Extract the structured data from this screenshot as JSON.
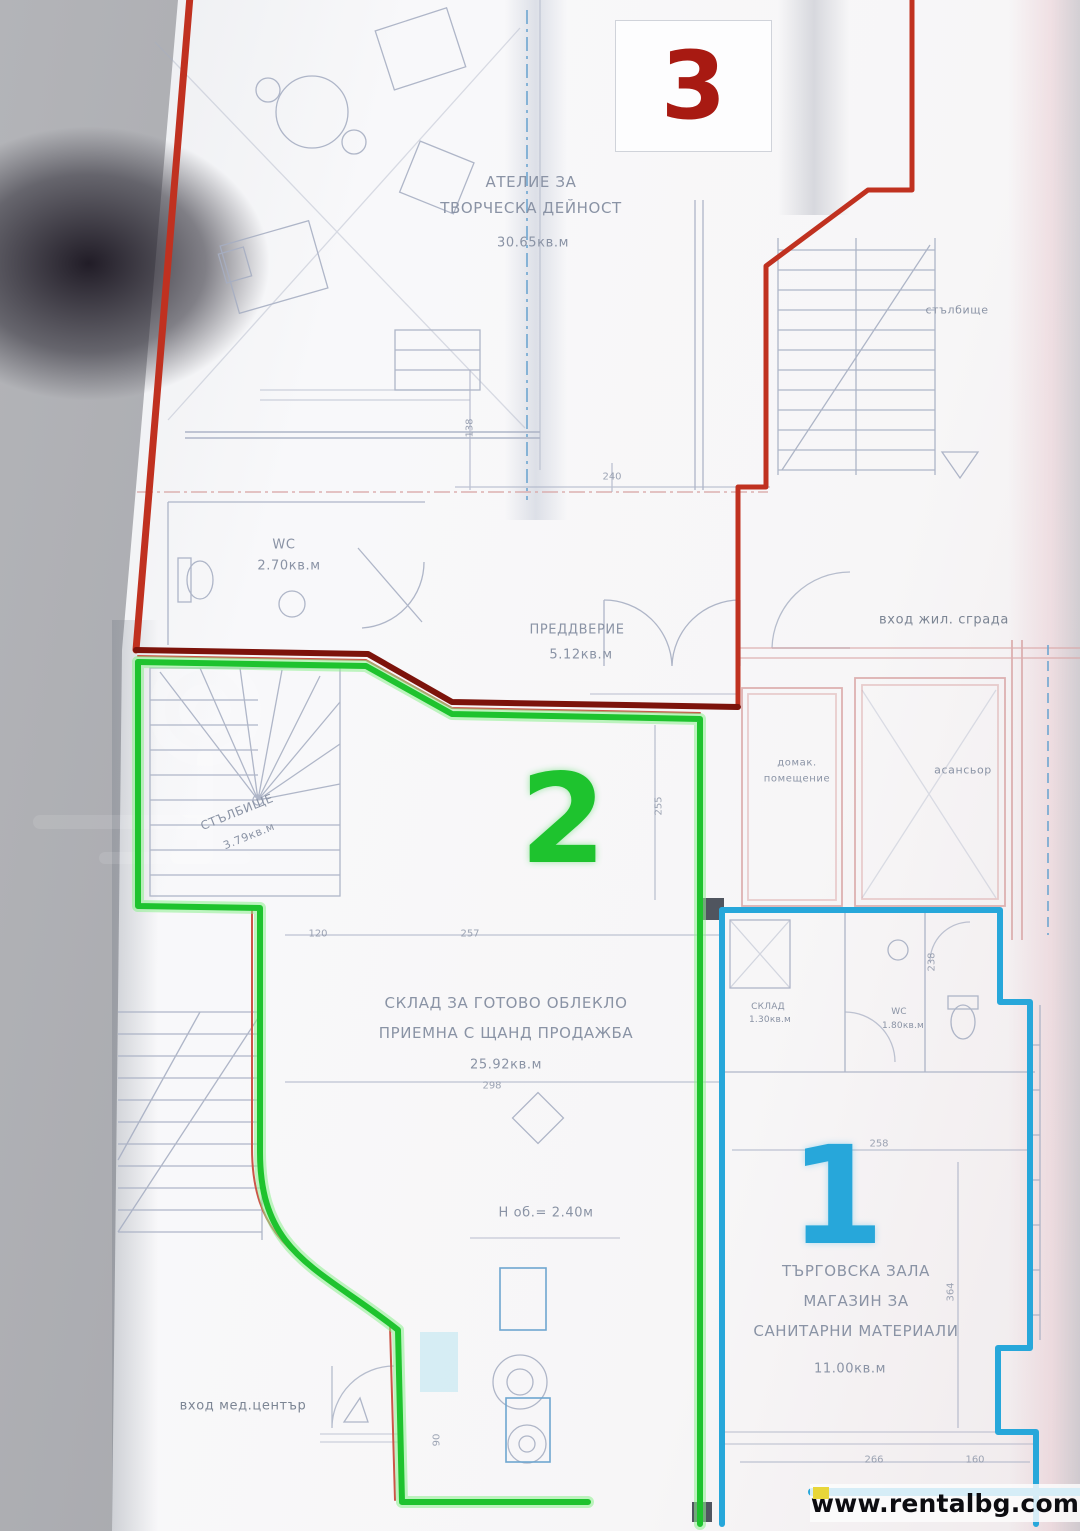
{
  "colors": {
    "unit1": "#27a7da",
    "unit2": "#1ec32e",
    "unit2_glow": "#8df08e",
    "unit3": "#c03120",
    "unit3_dark": "#7c130b",
    "thin_red": "#cc5548",
    "plan_line": "#a6aec2",
    "wall_pink": "#d8a4a4",
    "dash_blue": "#6ea6d0"
  },
  "units": {
    "u1": {
      "number": "1"
    },
    "u2": {
      "number": "2"
    },
    "u3": {
      "number": "3"
    }
  },
  "labels": {
    "atelier_l1": "АТЕЛИЕ ЗА",
    "atelier_l2": "ТВОРЧЕСКА ДЕЙНОСТ",
    "atelier_area": "30.65кв.м",
    "wc3": "WC",
    "wc3_area": "2.70кв.м",
    "vestibule": "ПРЕДДВЕРИЕ",
    "vestibule_area": "5.12кв.м",
    "entrance_residential": "вход жил. сграда",
    "staircase_top": "стълбище",
    "utility_l1": "домак.",
    "utility_l2": "помещение",
    "elevator": "асансьор",
    "staircase2": "СТЪЛБИЩЕ",
    "staircase2_area": "3.79кв.м",
    "storage2_l1": "СКЛАД ЗА ГОТОВО ОБЛЕКЛО",
    "storage2_l2": "ПРИЕМНА С ЩАНД ПРОДАЖБА",
    "storage2_area": "25.92кв.м",
    "height_note": "Н об.= 2.40м",
    "storage1": "СКЛАД",
    "storage1_area": "1.30кв.м",
    "wc1": "WC",
    "wc1_area": "1.80кв.м",
    "shop_l1": "ТЪРГОВСКА ЗАЛА",
    "shop_l2": "МАГАЗИН ЗА",
    "shop_l3": "САНИТАРНИ МАТЕРИАЛИ",
    "shop_area": "11.00кв.м",
    "entrance_medical": "вход мед.център"
  },
  "dims": {
    "d1": "120",
    "d2": "257",
    "d3": "258",
    "d4": "298",
    "d5": "266",
    "d6": "238",
    "d7": "364",
    "d8": "90",
    "d9": "160",
    "d10": "255",
    "d11": "138",
    "d12": "240"
  },
  "watermark": {
    "url": "www.rentalbg.com"
  }
}
